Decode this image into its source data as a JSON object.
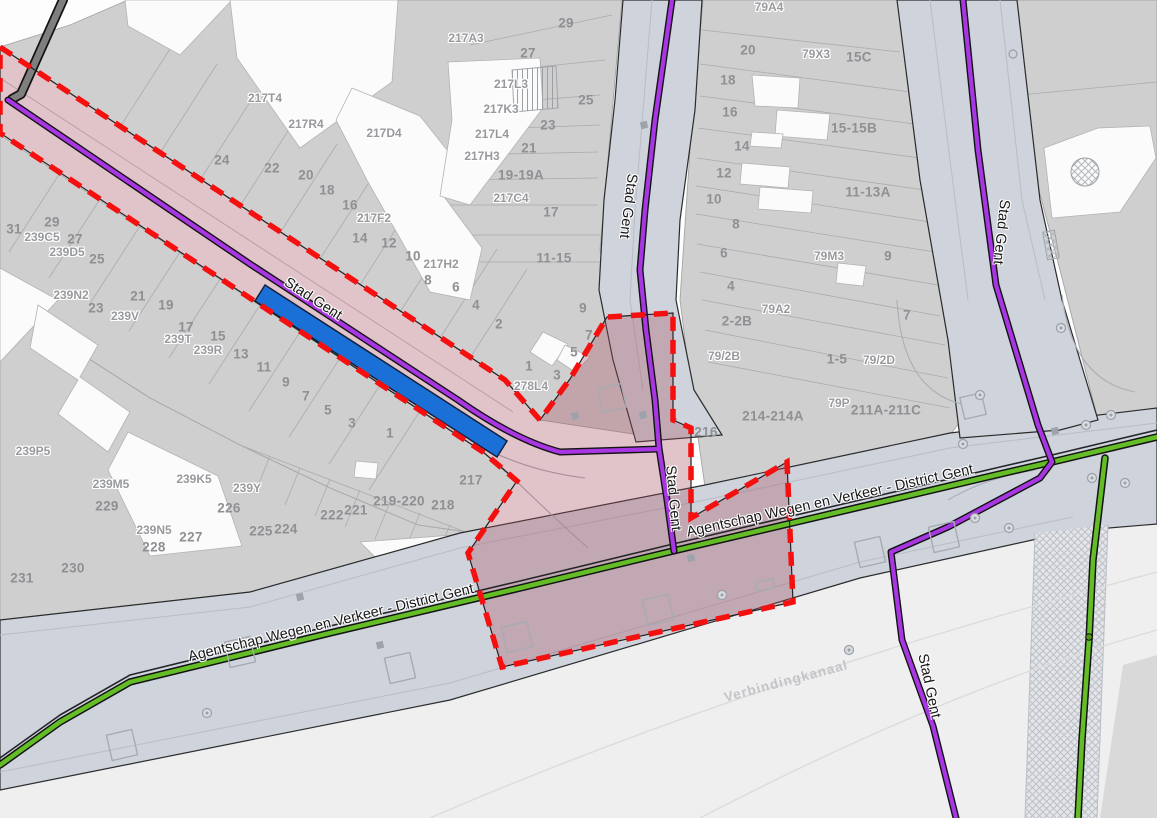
{
  "map": {
    "title": "Cadastral road-management map (GRB) with selected project zone",
    "colors": {
      "project_zone_fill": "#A64D5C",
      "boundary_red": "#F50F0F",
      "road_manager_purple": "#A936E3",
      "road_manager_green": "#64BC27",
      "selected_feature_blue": "#1B70D8",
      "road_fill": "#CED3DC",
      "parcel_fill": "#CFCFCF",
      "building_fill": "#FBFBFB"
    },
    "street_labels": [
      {
        "text": "Stad Gent",
        "x": 313,
        "y": 299,
        "rot": 33
      },
      {
        "text": "Stad Gent",
        "x": 628,
        "y": 206,
        "rot": 97
      },
      {
        "text": "Stad Gent",
        "x": 673,
        "y": 498,
        "rot": 85
      },
      {
        "text": "Stad Gent",
        "x": 1001,
        "y": 232,
        "rot": 96
      },
      {
        "text": "Stad Gent",
        "x": 929,
        "y": 686,
        "rot": 78
      },
      {
        "text": "Agentschap Wegen en Verkeer - District Gent",
        "x": 331,
        "y": 623,
        "rot": -13.5
      },
      {
        "text": "Agentschap Wegen en Verkeer - District Gent",
        "x": 830,
        "y": 501,
        "rot": -12.5
      }
    ],
    "waterway_label": {
      "text": "Verbindingkanaal",
      "x": 786,
      "y": 681,
      "rot": -15
    },
    "parcel_labels": [
      {
        "t": "31",
        "x": 14,
        "y": 229
      },
      {
        "t": "29",
        "x": 52,
        "y": 222
      },
      {
        "t": "239C5",
        "x": 42,
        "y": 237,
        "k": 1
      },
      {
        "t": "27",
        "x": 75,
        "y": 239
      },
      {
        "t": "239D5",
        "x": 67,
        "y": 252,
        "k": 1
      },
      {
        "t": "25",
        "x": 97,
        "y": 259
      },
      {
        "t": "239N2",
        "x": 71,
        "y": 295,
        "k": 1
      },
      {
        "t": "23",
        "x": 96,
        "y": 308
      },
      {
        "t": "21",
        "x": 138,
        "y": 296
      },
      {
        "t": "239V",
        "x": 125,
        "y": 316,
        "k": 1
      },
      {
        "t": "19",
        "x": 166,
        "y": 305
      },
      {
        "t": "17",
        "x": 186,
        "y": 327
      },
      {
        "t": "239T",
        "x": 178,
        "y": 339,
        "k": 1
      },
      {
        "t": "15",
        "x": 218,
        "y": 336
      },
      {
        "t": "239R",
        "x": 208,
        "y": 350,
        "k": 1
      },
      {
        "t": "13",
        "x": 241,
        "y": 354
      },
      {
        "t": "11",
        "x": 264,
        "y": 367
      },
      {
        "t": "9",
        "x": 286,
        "y": 382
      },
      {
        "t": "7",
        "x": 306,
        "y": 396
      },
      {
        "t": "5",
        "x": 328,
        "y": 410
      },
      {
        "t": "3",
        "x": 352,
        "y": 423
      },
      {
        "t": "1",
        "x": 390,
        "y": 433
      },
      {
        "t": "239P5",
        "x": 33,
        "y": 451,
        "k": 1
      },
      {
        "t": "239M5",
        "x": 111,
        "y": 484,
        "k": 1
      },
      {
        "t": "229",
        "x": 107,
        "y": 506
      },
      {
        "t": "239K5",
        "x": 194,
        "y": 479,
        "k": 1
      },
      {
        "t": "239Y",
        "x": 247,
        "y": 488,
        "k": 1
      },
      {
        "t": "226",
        "x": 229,
        "y": 508
      },
      {
        "t": "239N5",
        "x": 154,
        "y": 530,
        "k": 1
      },
      {
        "t": "227",
        "x": 191,
        "y": 537
      },
      {
        "t": "228",
        "x": 154,
        "y": 547
      },
      {
        "t": "225",
        "x": 261,
        "y": 531
      },
      {
        "t": "224",
        "x": 286,
        "y": 529
      },
      {
        "t": "230",
        "x": 73,
        "y": 568
      },
      {
        "t": "231",
        "x": 22,
        "y": 578
      },
      {
        "t": "222",
        "x": 332,
        "y": 515
      },
      {
        "t": "221",
        "x": 356,
        "y": 510
      },
      {
        "t": "219-220",
        "x": 399,
        "y": 501
      },
      {
        "t": "218",
        "x": 443,
        "y": 505
      },
      {
        "t": "217",
        "x": 471,
        "y": 480
      },
      {
        "t": "217T4",
        "x": 265,
        "y": 98,
        "k": 1
      },
      {
        "t": "217R4",
        "x": 306,
        "y": 124,
        "k": 1
      },
      {
        "t": "217D4",
        "x": 384,
        "y": 133,
        "k": 1
      },
      {
        "t": "24",
        "x": 222,
        "y": 160
      },
      {
        "t": "22",
        "x": 272,
        "y": 168
      },
      {
        "t": "20",
        "x": 306,
        "y": 175
      },
      {
        "t": "18",
        "x": 327,
        "y": 190
      },
      {
        "t": "16",
        "x": 350,
        "y": 205
      },
      {
        "t": "217F2",
        "x": 374,
        "y": 218,
        "k": 1
      },
      {
        "t": "14",
        "x": 360,
        "y": 238
      },
      {
        "t": "12",
        "x": 389,
        "y": 243
      },
      {
        "t": "10",
        "x": 413,
        "y": 256
      },
      {
        "t": "217H2",
        "x": 441,
        "y": 264,
        "k": 1
      },
      {
        "t": "8",
        "x": 428,
        "y": 280
      },
      {
        "t": "6",
        "x": 456,
        "y": 287
      },
      {
        "t": "4",
        "x": 476,
        "y": 305
      },
      {
        "t": "2",
        "x": 499,
        "y": 324
      },
      {
        "t": "217A3",
        "x": 466,
        "y": 38,
        "k": 1
      },
      {
        "t": "29",
        "x": 566,
        "y": 23
      },
      {
        "t": "27",
        "x": 528,
        "y": 53
      },
      {
        "t": "217L3",
        "x": 511,
        "y": 84,
        "k": 1
      },
      {
        "t": "25",
        "x": 586,
        "y": 100
      },
      {
        "t": "217K3",
        "x": 501,
        "y": 109,
        "k": 1
      },
      {
        "t": "23",
        "x": 548,
        "y": 125
      },
      {
        "t": "217L4",
        "x": 492,
        "y": 134,
        "k": 1
      },
      {
        "t": "21",
        "x": 529,
        "y": 148
      },
      {
        "t": "217H3",
        "x": 482,
        "y": 156,
        "k": 1
      },
      {
        "t": "19-19A",
        "x": 521,
        "y": 175
      },
      {
        "t": "217C4",
        "x": 511,
        "y": 198,
        "k": 1
      },
      {
        "t": "17",
        "x": 551,
        "y": 212
      },
      {
        "t": "11-15",
        "x": 554,
        "y": 258
      },
      {
        "t": "9",
        "x": 583,
        "y": 308
      },
      {
        "t": "7",
        "x": 589,
        "y": 335
      },
      {
        "t": "5",
        "x": 574,
        "y": 352
      },
      {
        "t": "3",
        "x": 557,
        "y": 375
      },
      {
        "t": "1",
        "x": 529,
        "y": 366
      },
      {
        "t": "278L4",
        "x": 531,
        "y": 386,
        "k": 1
      },
      {
        "t": "79A4",
        "x": 769,
        "y": 7,
        "k": 1
      },
      {
        "t": "20",
        "x": 748,
        "y": 50
      },
      {
        "t": "79X3",
        "x": 816,
        "y": 54,
        "k": 1
      },
      {
        "t": "15C",
        "x": 859,
        "y": 57
      },
      {
        "t": "18",
        "x": 728,
        "y": 80
      },
      {
        "t": "16",
        "x": 730,
        "y": 112
      },
      {
        "t": "15-15B",
        "x": 854,
        "y": 128
      },
      {
        "t": "14",
        "x": 742,
        "y": 146
      },
      {
        "t": "12",
        "x": 724,
        "y": 173
      },
      {
        "t": "10",
        "x": 714,
        "y": 199
      },
      {
        "t": "11-13A",
        "x": 868,
        "y": 192
      },
      {
        "t": "8",
        "x": 736,
        "y": 224
      },
      {
        "t": "6",
        "x": 724,
        "y": 253
      },
      {
        "t": "79M3",
        "x": 829,
        "y": 256,
        "k": 1
      },
      {
        "t": "9",
        "x": 888,
        "y": 256
      },
      {
        "t": "4",
        "x": 731,
        "y": 286
      },
      {
        "t": "79A2",
        "x": 776,
        "y": 309,
        "k": 1
      },
      {
        "t": "2-2B",
        "x": 737,
        "y": 321
      },
      {
        "t": "7",
        "x": 907,
        "y": 315
      },
      {
        "t": "79/2B",
        "x": 724,
        "y": 356,
        "k": 1
      },
      {
        "t": "1-5",
        "x": 837,
        "y": 359
      },
      {
        "t": "79/2D",
        "x": 879,
        "y": 360,
        "k": 1
      },
      {
        "t": "79P",
        "x": 839,
        "y": 403,
        "k": 1
      },
      {
        "t": "211A-211C",
        "x": 886,
        "y": 410
      },
      {
        "t": "214-214A",
        "x": 773,
        "y": 416
      },
      {
        "t": "216",
        "x": 706,
        "y": 432
      }
    ]
  }
}
